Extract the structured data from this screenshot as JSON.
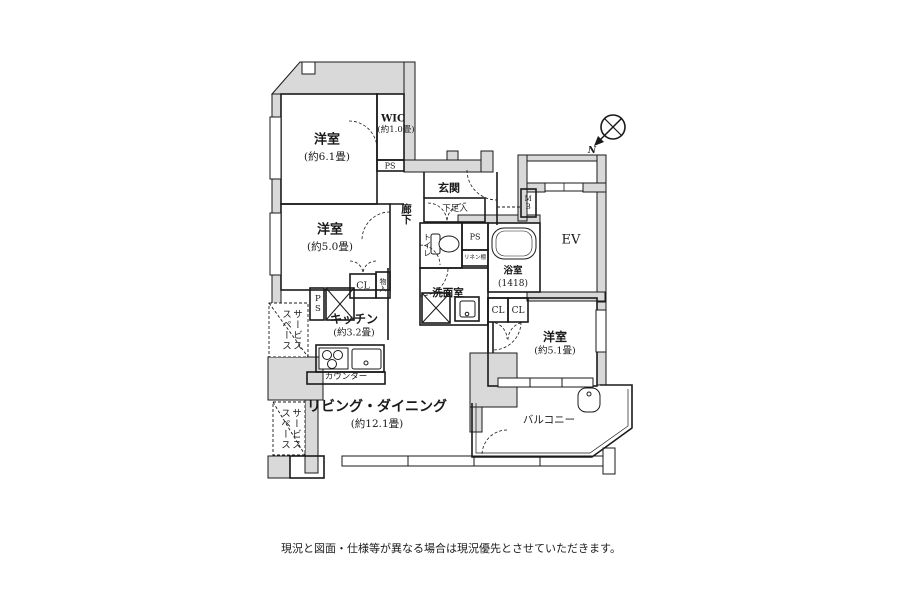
{
  "colors": {
    "wall_fill": "#d9d9d9",
    "line": "#1a1a1a",
    "background": "#ffffff"
  },
  "compass": {
    "north_label": "N"
  },
  "disclaimer": "現況と図面・仕様等が異なる場合は現況優先とさせていただきます。",
  "rooms": {
    "bedroom_a": {
      "name": "洋室",
      "size": "(約6.1畳)"
    },
    "wic": {
      "name": "WIC",
      "size": "(約1.0畳)"
    },
    "bedroom_b": {
      "name": "洋室",
      "size": "(約5.0畳)"
    },
    "entrance": {
      "name": "玄関"
    },
    "hallway": {
      "name": "廊下"
    },
    "shoe_cabinet": {
      "name": "下足入"
    },
    "toilet": {
      "name": "トイレ"
    },
    "bathroom": {
      "name": "浴室",
      "size": "(1418)"
    },
    "washroom": {
      "name": "洗面室"
    },
    "elevator": {
      "name": "EV"
    },
    "meter_box": {
      "name": "MB"
    },
    "kitchen": {
      "name": "キッチン",
      "size": "(約3.2畳)"
    },
    "counter": {
      "name": "カウンター"
    },
    "living_dining": {
      "name": "リビング・ダイニング",
      "size": "(約12.1畳)"
    },
    "bedroom_c": {
      "name": "洋室",
      "size": "(約5.1畳)"
    },
    "balcony": {
      "name": "バルコニー"
    },
    "service_space_upper": {
      "name": "サービススペース"
    },
    "service_space_lower": {
      "name": "サービススペース"
    },
    "closet_kitchen": {
      "name": "CL"
    },
    "storage": {
      "name": "物入"
    },
    "closet_a": {
      "name": "CL"
    },
    "closet_b": {
      "name": "CL"
    },
    "pipe_space_top": {
      "name": "PS"
    },
    "pipe_space_mid": {
      "name": "PS"
    },
    "pipe_space_left": {
      "name": "PS"
    },
    "linen_shelf": {
      "name": "リネン棚"
    }
  }
}
